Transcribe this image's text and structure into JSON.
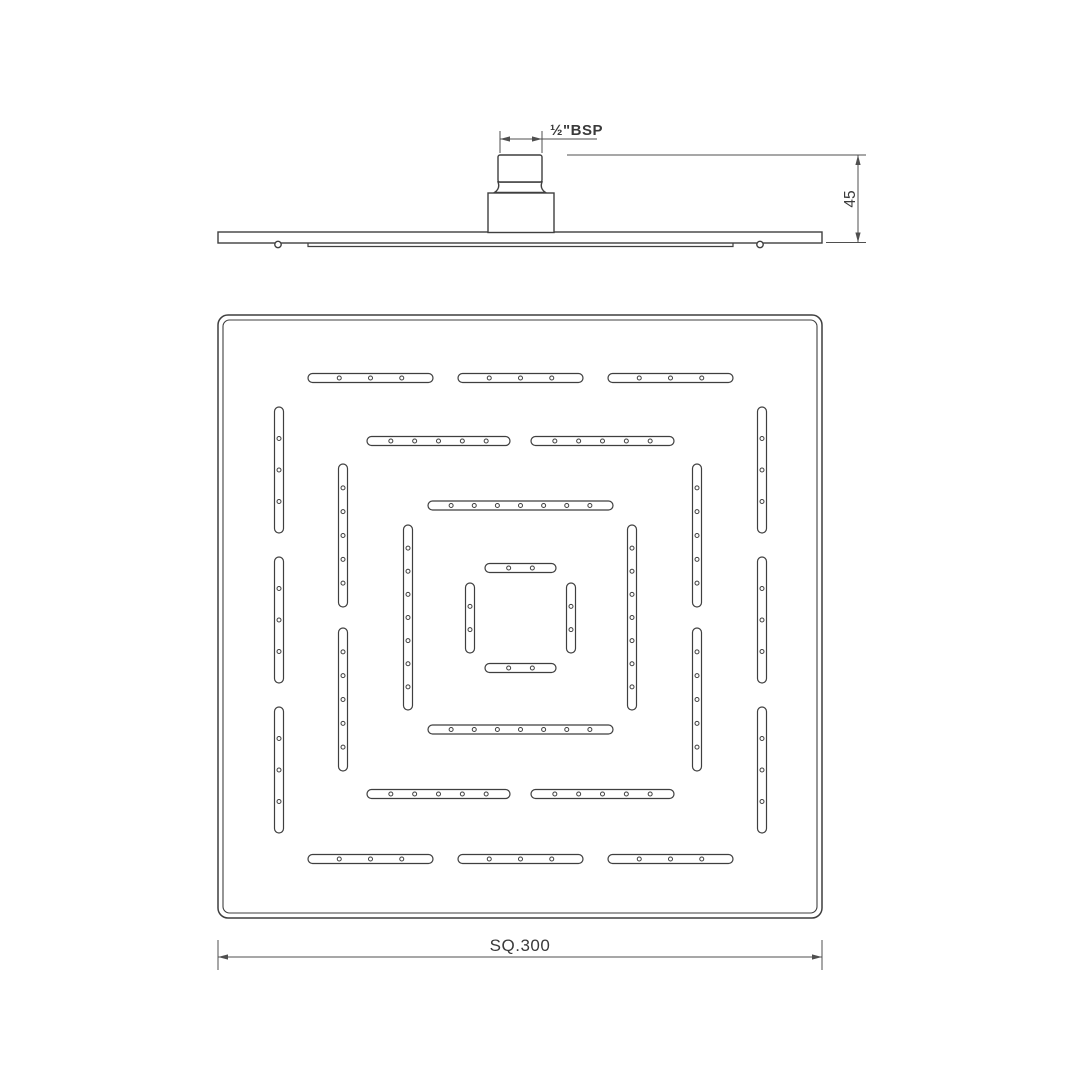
{
  "labels": {
    "thread": "½\"BSP",
    "height": "45",
    "size": "SQ.300"
  },
  "colors": {
    "background": "#ffffff",
    "line": "#3f3f3f",
    "dim": "#4f4f4f",
    "text": "#3a3a3a"
  },
  "pattern": {
    "slot_width": 9,
    "dot_radius": 2,
    "slots": [
      {
        "o": "h",
        "c": 378,
        "a": 308,
        "b": 433,
        "d": 3
      },
      {
        "o": "h",
        "c": 378,
        "a": 458,
        "b": 583,
        "d": 3
      },
      {
        "o": "h",
        "c": 378,
        "a": 608,
        "b": 733,
        "d": 3
      },
      {
        "o": "h",
        "c": 441,
        "a": 367,
        "b": 510,
        "d": 5
      },
      {
        "o": "h",
        "c": 441,
        "a": 531,
        "b": 674,
        "d": 5
      },
      {
        "o": "h",
        "c": 505.5,
        "a": 428,
        "b": 613,
        "d": 7
      },
      {
        "o": "h",
        "c": 568,
        "a": 485,
        "b": 556,
        "d": 2
      },
      {
        "o": "h",
        "c": 668,
        "a": 485,
        "b": 556,
        "d": 2
      },
      {
        "o": "h",
        "c": 729.5,
        "a": 428,
        "b": 613,
        "d": 7
      },
      {
        "o": "h",
        "c": 794,
        "a": 367,
        "b": 510,
        "d": 5
      },
      {
        "o": "h",
        "c": 794,
        "a": 531,
        "b": 674,
        "d": 5
      },
      {
        "o": "h",
        "c": 859,
        "a": 308,
        "b": 433,
        "d": 3
      },
      {
        "o": "h",
        "c": 859,
        "a": 458,
        "b": 583,
        "d": 3
      },
      {
        "o": "h",
        "c": 859,
        "a": 608,
        "b": 733,
        "d": 3
      },
      {
        "o": "v",
        "c": 279,
        "a": 407,
        "b": 533,
        "d": 3
      },
      {
        "o": "v",
        "c": 279,
        "a": 557,
        "b": 683,
        "d": 3
      },
      {
        "o": "v",
        "c": 279,
        "a": 707,
        "b": 833,
        "d": 3
      },
      {
        "o": "v",
        "c": 343,
        "a": 464,
        "b": 607,
        "d": 5
      },
      {
        "o": "v",
        "c": 343,
        "a": 628,
        "b": 771,
        "d": 5
      },
      {
        "o": "v",
        "c": 408,
        "a": 525,
        "b": 710,
        "d": 7
      },
      {
        "o": "v",
        "c": 470,
        "a": 583,
        "b": 653,
        "d": 2
      },
      {
        "o": "v",
        "c": 571,
        "a": 583,
        "b": 653,
        "d": 2
      },
      {
        "o": "v",
        "c": 632,
        "a": 525,
        "b": 710,
        "d": 7
      },
      {
        "o": "v",
        "c": 697,
        "a": 464,
        "b": 607,
        "d": 5
      },
      {
        "o": "v",
        "c": 697,
        "a": 628,
        "b": 771,
        "d": 5
      },
      {
        "o": "v",
        "c": 762,
        "a": 407,
        "b": 533,
        "d": 3
      },
      {
        "o": "v",
        "c": 762,
        "a": 557,
        "b": 683,
        "d": 3
      },
      {
        "o": "v",
        "c": 762,
        "a": 707,
        "b": 833,
        "d": 3
      }
    ]
  }
}
